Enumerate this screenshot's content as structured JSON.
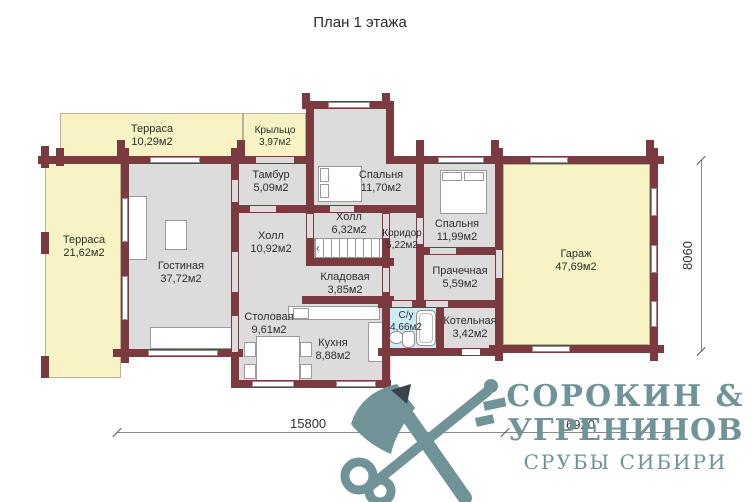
{
  "title": "План 1 этажа",
  "rooms": [
    {
      "name": "Терраса",
      "area": "10,29м2"
    },
    {
      "name": "Крыльцо",
      "area": "3,97м2"
    },
    {
      "name": "Терраса",
      "area": "21,62м2"
    },
    {
      "name": "Тамбур",
      "area": "5,09м2"
    },
    {
      "name": "Спальня",
      "area": "11,70м2"
    },
    {
      "name": "Холл",
      "area": "6,32м2"
    },
    {
      "name": "Коридор",
      "area": "5,22м2"
    },
    {
      "name": "Холл",
      "area": "10,92м2"
    },
    {
      "name": "Спальня",
      "area": "11,99м2"
    },
    {
      "name": "Гостиная",
      "area": "37,72м2"
    },
    {
      "name": "Кладовая",
      "area": "3,85м2"
    },
    {
      "name": "Прачечная",
      "area": "5,59м2"
    },
    {
      "name": "Гараж",
      "area": "47,69м2"
    },
    {
      "name": "Столовая",
      "area": "9,61м2"
    },
    {
      "name": "С/у",
      "area": "4,66м2"
    },
    {
      "name": "Котельная",
      "area": "3,42м2"
    },
    {
      "name": "Кухня",
      "area": "8,88м2"
    }
  ],
  "dimensions": {
    "overall_width": "15800",
    "garage_width": "6920",
    "right_height": "8060"
  },
  "logo": {
    "brand_line1": "СОРОКИН &",
    "brand_line2": "УГРЕНИНОВ",
    "tagline": "СРУБЫ СИБИРИ"
  },
  "colors": {
    "wall": "#7b3a3f",
    "terrace": "#f7f3c4",
    "floor": "#dcdcdc",
    "bathroom": "#cdeaf6",
    "logo": "#6f9397"
  }
}
